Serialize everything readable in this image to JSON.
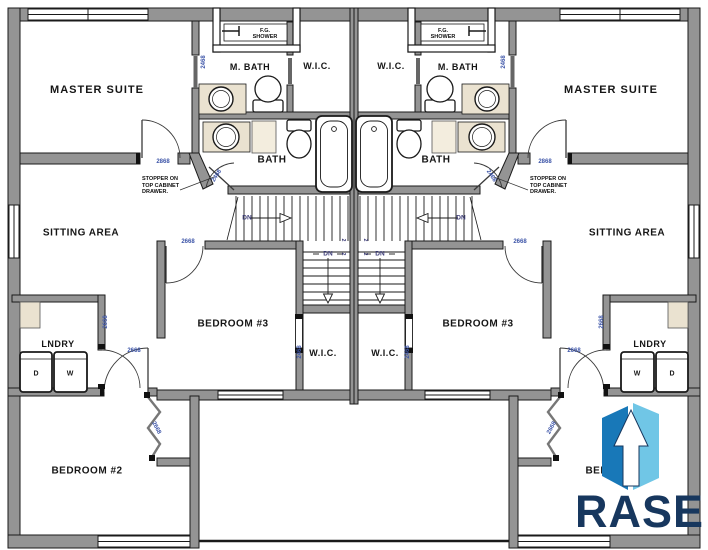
{
  "plan": {
    "type": "duplex upper floor plan, mirrored left/right units"
  },
  "labels": {
    "unit": {
      "master_suite": "MASTER SUITE",
      "m_bath": "M. BATH",
      "wic": "W.I.C.",
      "shower_l1": "F.G.",
      "shower_l2": "SHOWER",
      "bath": "BATH",
      "sitting_area": "SITTING AREA",
      "lndry": "LNDRY",
      "dryer": "D",
      "washer": "W",
      "bedroom3": "BEDROOM #3",
      "wic2": "W.I.C.",
      "bedroom2": "BEDROOM #2",
      "note_l1": "STOPPER ON",
      "note_l2": "TOP CABINET",
      "note_l3": "DRAWER.",
      "dn": "DN",
      "stair_riser": "2",
      "door_2468": "2468",
      "door_2868": "2868",
      "door_2668": "2668"
    },
    "logo": {
      "brand": "RASE"
    }
  },
  "colors": {
    "wall_gray": "#949494",
    "line_black": "#1a1a1a",
    "door_label_blue": "#3d55a8",
    "dn_blue": "#3c3c78",
    "counter_beige": "#eae2d0",
    "logo_navy": "#17375e",
    "logo_blue_dark": "#1878b8",
    "logo_blue_light": "#70c6e6",
    "background": "#ffffff"
  }
}
